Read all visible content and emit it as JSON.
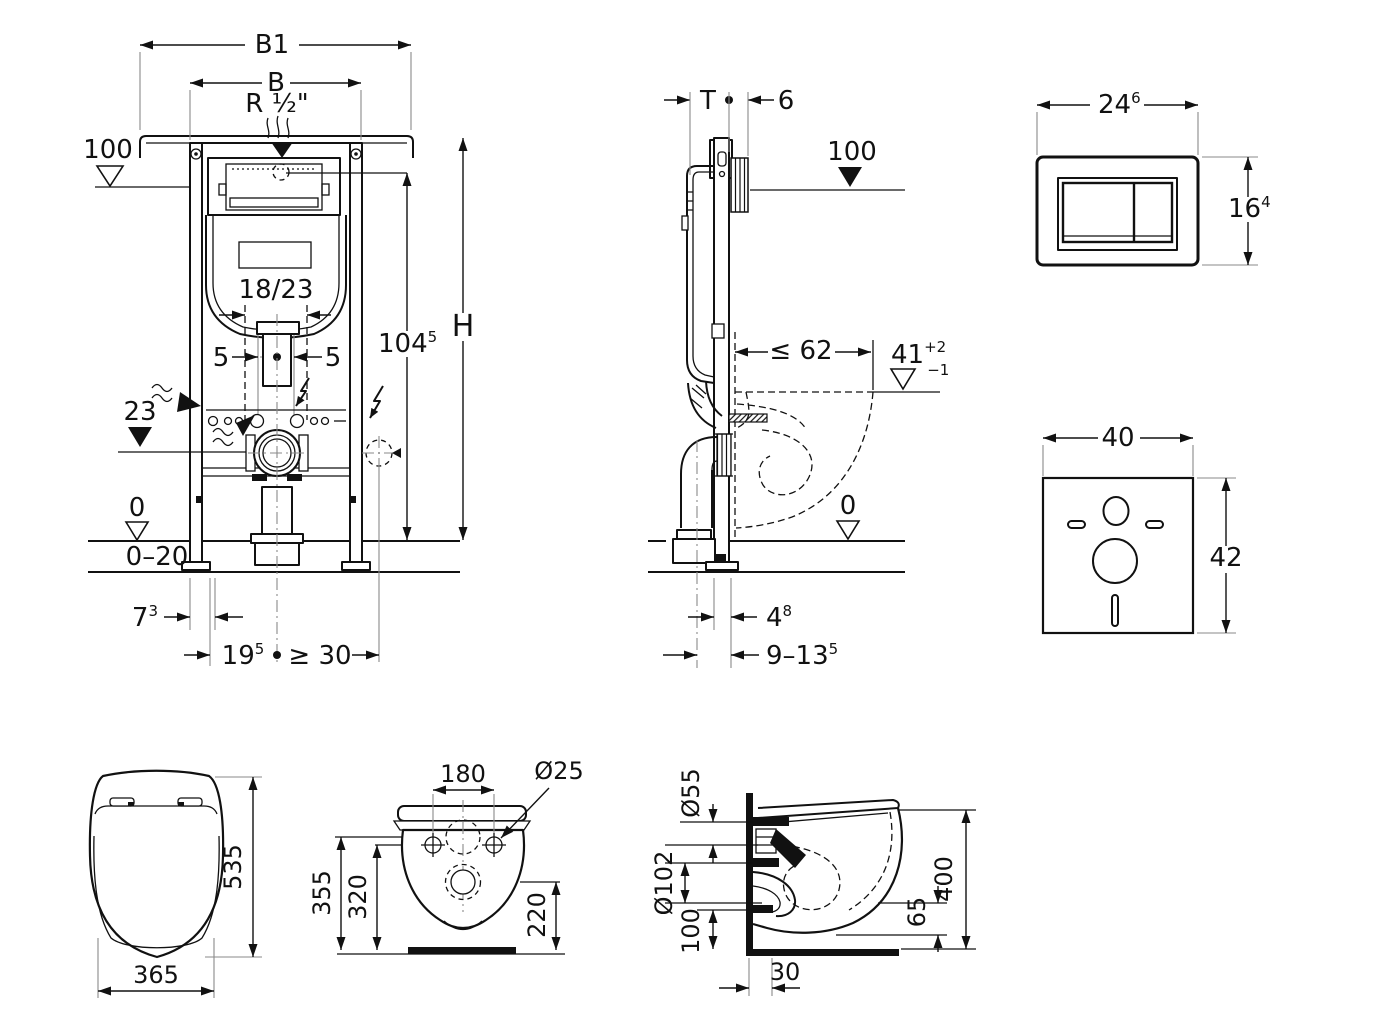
{
  "colors": {
    "line": "#111111",
    "extension_line": "#8a8a8a",
    "background": "#ffffff"
  },
  "icons": {
    "water_supply": "wavy-lines-with-arrow",
    "electrical_connection": "lightning-bolt-arrow",
    "level_marker_open": "open-triangle",
    "level_marker_filled": "filled-triangle"
  },
  "frame_front": {
    "b1": "B1",
    "b": "B",
    "r_half": "R ½\"",
    "level_100": "100",
    "inset": "18/23",
    "five_left": "5",
    "five_right": "5",
    "level_23": "23",
    "h104_main": "104",
    "h104_sup": "5",
    "h": "H",
    "level_0": "0",
    "floor_range": "0–20",
    "d7_main": "7",
    "d7_sup": "3",
    "d19_main": "19",
    "d19_sup": "5",
    "ge30": "≥ 30"
  },
  "frame_side": {
    "t": "T",
    "six": "6",
    "level_100": "100",
    "le62": "≤ 62",
    "d41_main": "41",
    "d41_sup": "+2",
    "d41_sub": "−1",
    "level_0": "0",
    "d4_main": "4",
    "d4_sup": "8",
    "d9_main": "9–13",
    "d9_sup": "5"
  },
  "flush_plate": {
    "w_main": "24",
    "w_sup": "6",
    "h_main": "16",
    "h_sup": "4"
  },
  "sound_mat": {
    "w": "40",
    "h": "42"
  },
  "seat_top": {
    "depth": "535",
    "width": "365"
  },
  "bowl_front": {
    "holes": "180",
    "dia": "Ø25",
    "h355": "355",
    "h320": "320",
    "h220": "220"
  },
  "bowl_side": {
    "d55": "Ø55",
    "d102": "Ø102",
    "d100": "100",
    "d30": "30",
    "d65": "65",
    "d400": "400"
  }
}
